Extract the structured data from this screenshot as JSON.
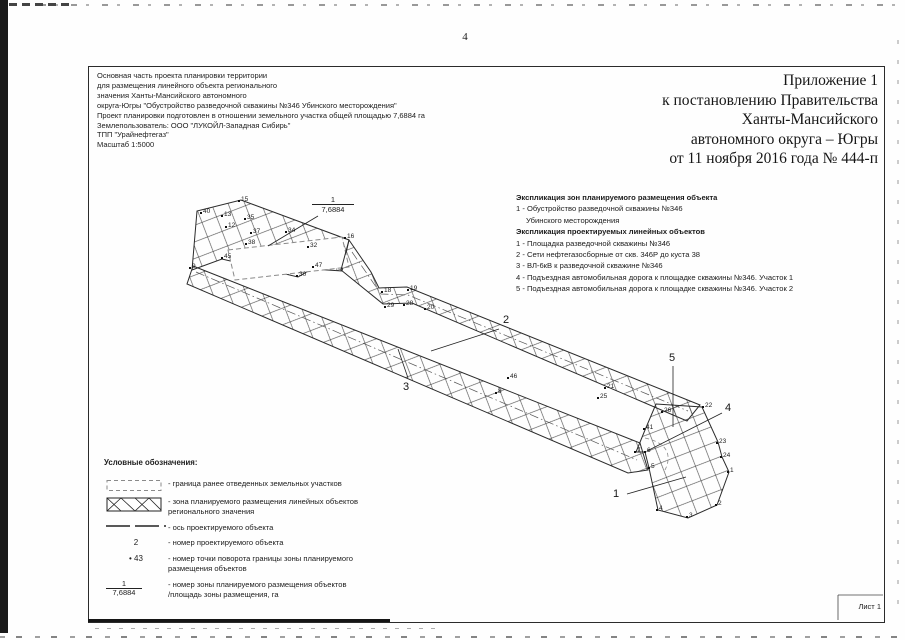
{
  "page": {
    "number": "4",
    "sheet_label": "Лист 1"
  },
  "accent_colors": {
    "ink": "#1c1c1c",
    "paper": "#fefefe"
  },
  "project_block": {
    "lines": [
      "Основная часть проекта планировки территории",
      "для размещения линейного объекта регионального",
      "значения Ханты-Мансийского автономного",
      "округа-Югры \"Обустройство разведочной скважины №346 Убинского месторождения\"",
      "Проект планировки подготовлен в отношении земельного участка общей площадью 7,6884 га",
      "Землепользователь: ООО \"ЛУКОЙЛ-Западная Сибирь\"",
      "ТПП \"Урайнефтегаз\"",
      "Масштаб 1:5000"
    ]
  },
  "appendix": {
    "lines": [
      "Приложение 1",
      "к постановлению Правительства",
      "Ханты-Мансийского",
      "автономного округа – Югры",
      "от 11 ноября 2016 года № 444-п"
    ]
  },
  "explication": {
    "zones_title": "Экспликация зон планируемого размещения объекта",
    "zones_item": "1 - Обустройство разведочной скважины №346",
    "zones_item_cont": "Убинского месторождения",
    "linear_title": "Экспликация проектируемых линейных объектов",
    "linear_items": [
      "1 - Площадка разведочной скважины №346",
      "2 - Сети нефтегазосборные от скв. 346Р до куста 38",
      "3 - ВЛ-6кВ к разведочной скважине №346",
      "4 - Подъездная автомобильная дорога к площадке скважины №346. Участок 1",
      "5 - Подъездная автомобильная дорога к площадке скважины №346. Участок 2"
    ]
  },
  "legend": {
    "title": "Условные обозначения:",
    "items": [
      {
        "label": "- граница ранее отведенных земельных участков",
        "label2": ""
      },
      {
        "label": "- зона планируемого размещения линейных объектов",
        "label2": "регионального значения"
      },
      {
        "label": "- ось проектируемого объекта",
        "label2": ""
      },
      {
        "symbol": "2",
        "label": "- номер проектируемого объекта",
        "label2": ""
      },
      {
        "symbol": "• 43",
        "label": "- номер точки поворота границы зоны планируемого",
        "label2": "размещения объектов"
      },
      {
        "num": "1",
        "den": "7,6884",
        "label": "- номер зоны планируемого размещения объектов",
        "label2": "/площадь зоны размещения, га"
      }
    ]
  },
  "drawing": {
    "zone_label": {
      "num": "1",
      "den": "7,6884"
    },
    "object_labels": [
      {
        "n": "2",
        "x": 503,
        "y": 314
      },
      {
        "n": "3",
        "x": 403,
        "y": 381
      },
      {
        "n": "5",
        "x": 669,
        "y": 352
      },
      {
        "n": "4",
        "x": 725,
        "y": 402
      },
      {
        "n": "1",
        "x": 613,
        "y": 488
      }
    ],
    "points": [
      {
        "n": "15",
        "x": 238,
        "y": 200
      },
      {
        "n": "40",
        "x": 200,
        "y": 212
      },
      {
        "n": "13",
        "x": 221,
        "y": 215
      },
      {
        "n": "35",
        "x": 244,
        "y": 218
      },
      {
        "n": "12",
        "x": 225,
        "y": 226
      },
      {
        "n": "37",
        "x": 250,
        "y": 232
      },
      {
        "n": "38",
        "x": 245,
        "y": 243
      },
      {
        "n": "34",
        "x": 285,
        "y": 231
      },
      {
        "n": "16",
        "x": 344,
        "y": 237
      },
      {
        "n": "32",
        "x": 307,
        "y": 246
      },
      {
        "n": "47",
        "x": 312,
        "y": 266
      },
      {
        "n": "30",
        "x": 296,
        "y": 275
      },
      {
        "n": "45",
        "x": 221,
        "y": 257
      },
      {
        "n": "9",
        "x": 189,
        "y": 267
      },
      {
        "n": "18",
        "x": 381,
        "y": 291
      },
      {
        "n": "19",
        "x": 407,
        "y": 289
      },
      {
        "n": "29",
        "x": 384,
        "y": 306
      },
      {
        "n": "28",
        "x": 403,
        "y": 304
      },
      {
        "n": "20",
        "x": 424,
        "y": 308
      },
      {
        "n": "46",
        "x": 507,
        "y": 377
      },
      {
        "n": "8",
        "x": 495,
        "y": 392
      },
      {
        "n": "21",
        "x": 604,
        "y": 387
      },
      {
        "n": "25",
        "x": 597,
        "y": 397
      },
      {
        "n": "26",
        "x": 661,
        "y": 411
      },
      {
        "n": "41",
        "x": 643,
        "y": 428
      },
      {
        "n": "22",
        "x": 702,
        "y": 406
      },
      {
        "n": "23",
        "x": 716,
        "y": 442
      },
      {
        "n": "24",
        "x": 720,
        "y": 456
      },
      {
        "n": "1",
        "x": 727,
        "y": 471
      },
      {
        "n": "2",
        "x": 715,
        "y": 504
      },
      {
        "n": "3",
        "x": 686,
        "y": 516
      },
      {
        "n": "4",
        "x": 656,
        "y": 509
      },
      {
        "n": "5",
        "x": 648,
        "y": 467
      },
      {
        "n": "6",
        "x": 644,
        "y": 451
      },
      {
        "n": "7",
        "x": 634,
        "y": 451
      }
    ]
  }
}
